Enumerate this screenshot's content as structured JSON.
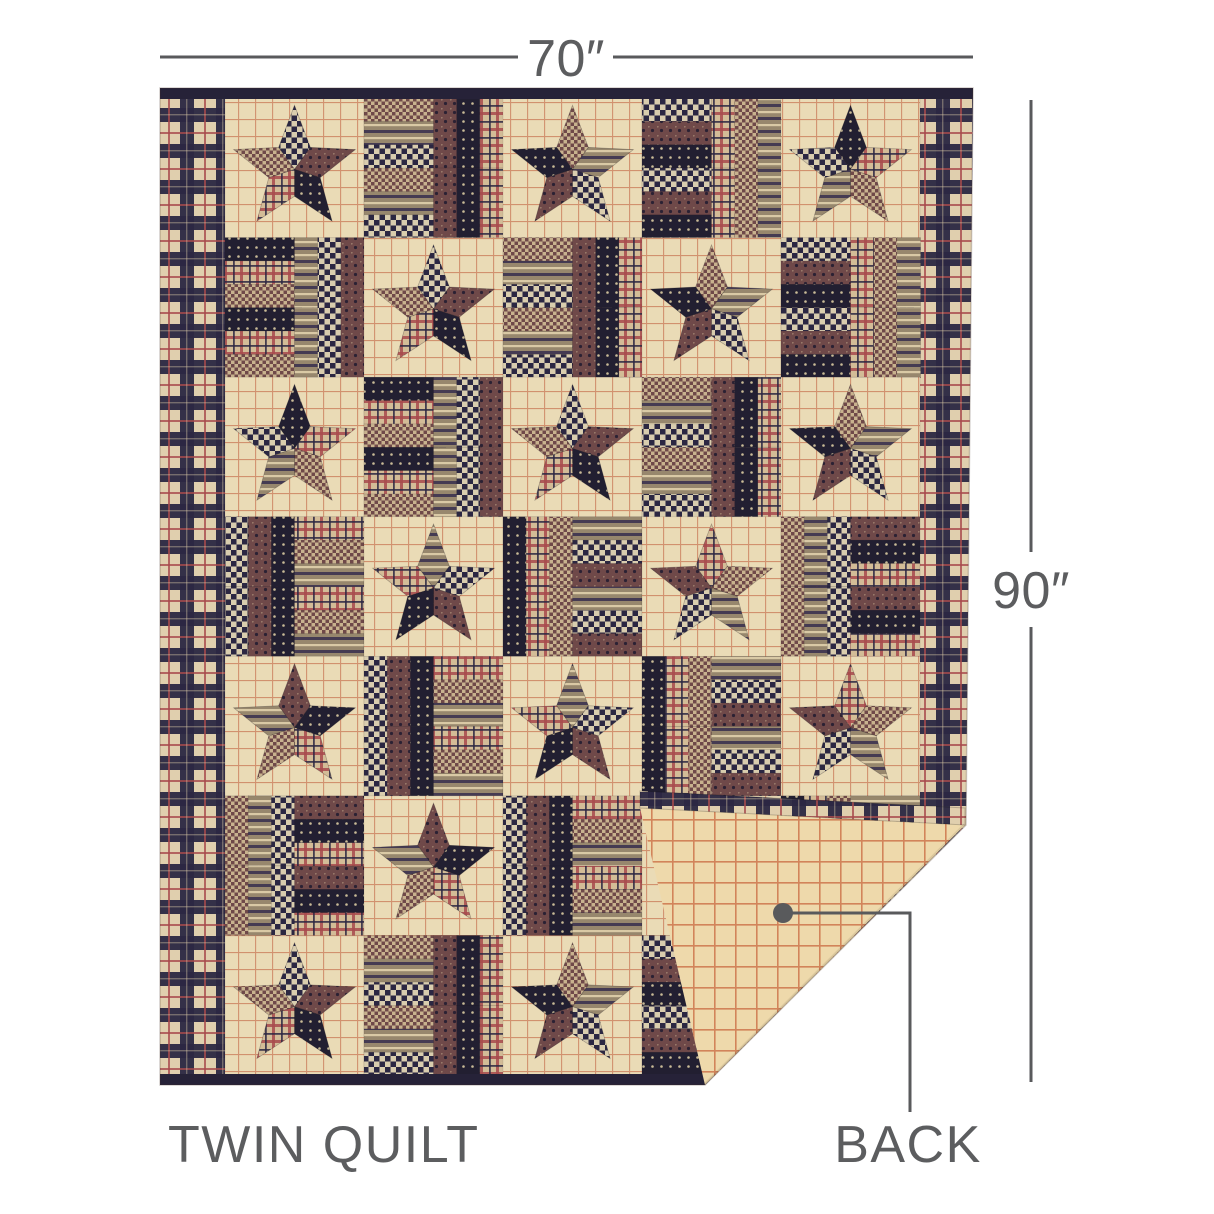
{
  "page": {
    "background_color": "#ffffff"
  },
  "annotations": {
    "width_label": "70″",
    "height_label": "90″",
    "product_variant_label": "TWIN QUILT",
    "back_callout_label": "BACK",
    "line_color": "#595a5c",
    "text_color": "#5c5d5f"
  },
  "quilt": {
    "description": "Primitive patchwork five-point star quilt with log-cabin strip blocks, navy plaid side borders, dark binding, bottom-right corner folded over to show tan windowpane-check backing",
    "grid_rows": 7,
    "grid_cols": 5,
    "palette": {
      "cream": "#eadbb6",
      "grid_rust": "#bf5f3d",
      "back_cream": "#eed9ab",
      "back_grid": "#c75f38",
      "navy": "#2b2742",
      "navy_dark": "#221f31",
      "maroon": "#6f4949",
      "taupe": "#97876d",
      "plaid_base": "#e0cfae",
      "red": "#a84a4c",
      "check_light": "#d9cdae",
      "stripe_light": "#d9c9a5",
      "check_tan": "#c8b28e",
      "tan": "#d3bc97",
      "dot_light": "#c9bb97",
      "dot_dark": "#2b2133",
      "accent_dark": "#453b52",
      "binding": "#262238"
    }
  }
}
